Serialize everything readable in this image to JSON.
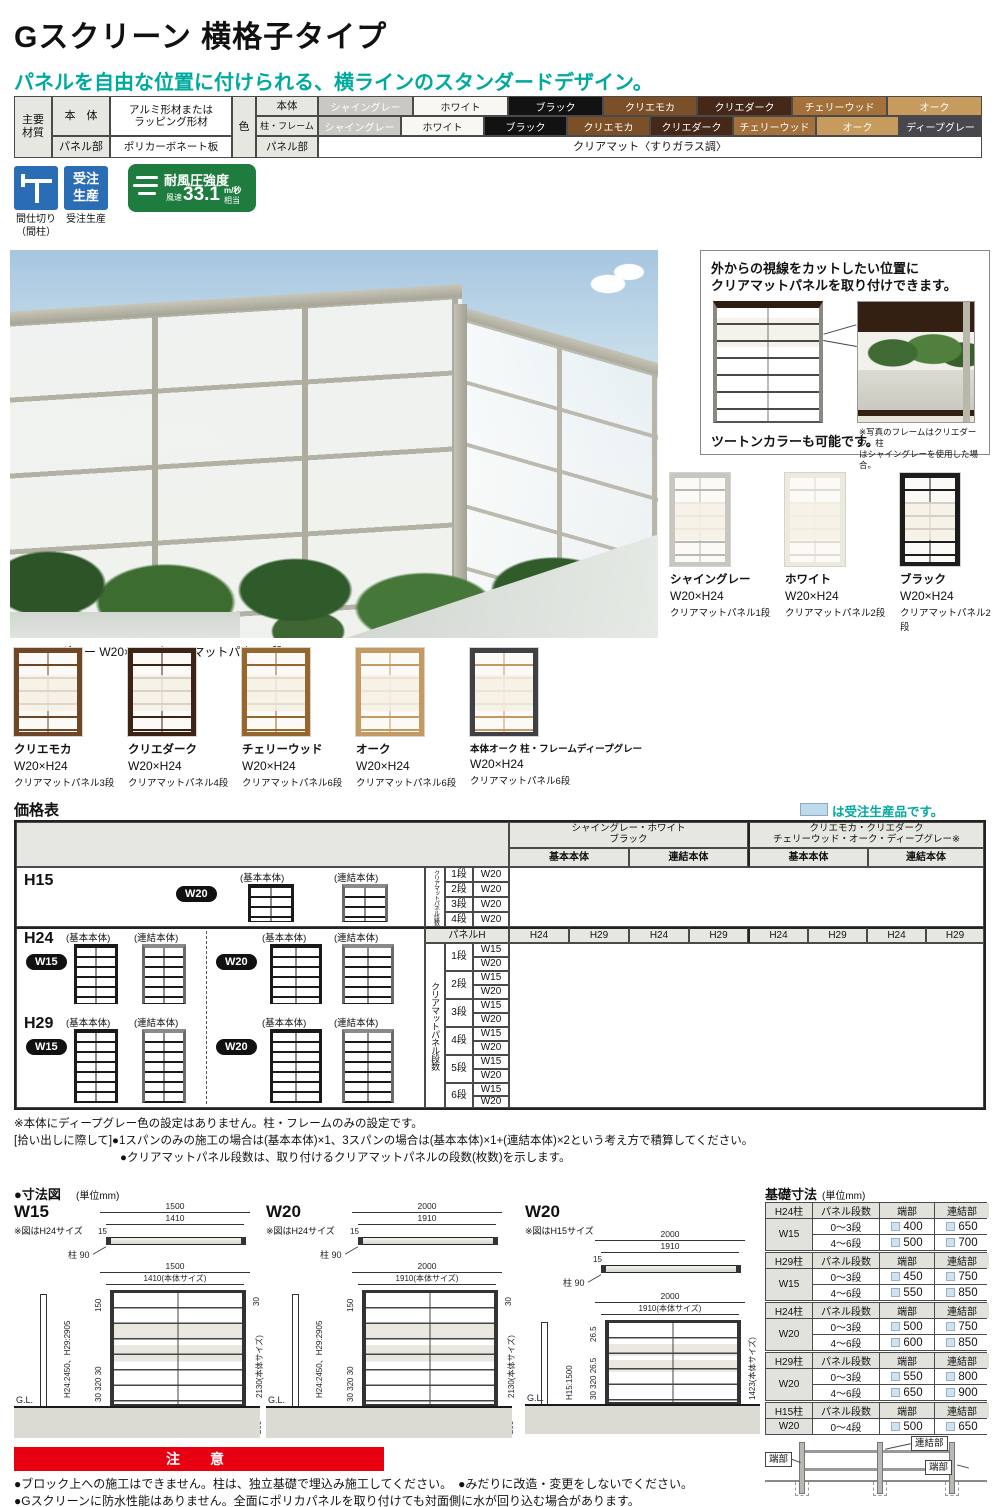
{
  "page": {
    "title": "Gスクリーン 横格子タイプ",
    "subtitle": "パネルを自由な位置に付けられる、横ラインのスタンダードデザイン。"
  },
  "palette": {
    "teal": "#00a99d",
    "red": "#e60012",
    "badge_blue": "#2b6db4",
    "badge_green": "#1e7c3f",
    "legend_blue": "#bedbed",
    "header_gray": "#e7e7e2",
    "shine_gray": "#c9c8c3",
    "white": "#f8f7f2",
    "black": "#121212",
    "crea_mocha": "#7b5029",
    "crea_dark": "#452818",
    "cherry_wood": "#a4713a",
    "oak": "#c79a5d",
    "deep_gray": "#47474d"
  },
  "materials": {
    "main_header": "主要\n材質",
    "body_label": "本　体",
    "body_value": "アルミ形材または\nラッピング形材",
    "panel_part_label": "パネル部",
    "panel_part_value": "ポリカーボネート板",
    "color_header": "色",
    "color_body_label": "本体",
    "color_frame_label": "柱・フレーム",
    "color_panel_label": "パネル部",
    "color_panel_value": "クリアマット〈すりガラス調〉",
    "body_chips": [
      "シャイングレー",
      "ホワイト",
      "ブラック",
      "クリエモカ",
      "クリエダーク",
      "チェリーウッド",
      "オーク"
    ],
    "frame_chips": [
      "シャイングレー",
      "ホワイト",
      "ブラック",
      "クリエモカ",
      "クリエダーク",
      "チェリーウッド",
      "オーク",
      "ディープグレー"
    ]
  },
  "badges": {
    "partition_caption": "間仕切り\n（間柱）",
    "order_icon": "受注\n生産",
    "order_caption": "受注生産",
    "wind_title": "耐風圧強度",
    "wind_prefix": "風速",
    "wind_value": "33.1",
    "wind_unit": "m/秒",
    "wind_suffix": "相当"
  },
  "photo": {
    "caption": "シャイングレー W20×H29 クリアマットパネル5段"
  },
  "callout": {
    "line1": "外からの視線をカットしたい位置に",
    "line2": "クリアマットパネルを取り付けできます。",
    "left_caption": "ツートンカラーも可能です。",
    "right_caption": "※写真のフレームはクリエダーク、柱\nはシャイングレーを使用した場合。"
  },
  "variations": {
    "row1": [
      {
        "name": "シャイングレー",
        "size": "W20×H24",
        "panel": "クリアマットパネル1段"
      },
      {
        "name": "ホワイト",
        "size": "W20×H24",
        "panel": "クリアマットパネル2段"
      },
      {
        "name": "ブラック",
        "size": "W20×H24",
        "panel": "クリアマットパネル2段"
      }
    ],
    "row2": [
      {
        "name": "クリエモカ",
        "size": "W20×H24",
        "panel": "クリアマットパネル3段"
      },
      {
        "name": "クリエダーク",
        "size": "W20×H24",
        "panel": "クリアマットパネル4段"
      },
      {
        "name": "チェリーウッド",
        "size": "W20×H24",
        "panel": "クリアマットパネル6段"
      },
      {
        "name": "オーク",
        "size": "W20×H24",
        "panel": "クリアマットパネル6段"
      },
      {
        "name": "本体オーク 柱・フレームディープグレー",
        "size": "W20×H24",
        "panel": "クリアマットパネル6段"
      }
    ]
  },
  "price": {
    "title": "価格表",
    "legend_text": "は受注生産品です。",
    "group1_line1": "シャイングレー・ホワイト",
    "group1_line2": "ブラック",
    "group2_line1": "クリエモカ・クリエダーク",
    "group2_line2": "チェリーウッド・オーク・ディープグレー※",
    "col_basic": "基本本体",
    "col_link": "連結本体",
    "h15_label": "H15",
    "h24_label": "H24",
    "h29_label": "H29",
    "tag_w15": "W15",
    "tag_w20": "W20",
    "cap_basic": "(基本本体)",
    "cap_link": "(連結本体)",
    "vert_label": "クリアマットパネル段数",
    "panel_h": "パネルH",
    "h_cols": [
      "H24",
      "H29",
      "H24",
      "H29",
      "H24",
      "H29",
      "H24",
      "H29"
    ],
    "h15_dan": [
      "1段",
      "2段",
      "3段",
      "4段"
    ],
    "dan": [
      "1段",
      "2段",
      "3段",
      "4段",
      "5段",
      "6段"
    ],
    "notes": [
      "※本体にディープグレー色の設定はありません。柱・フレームのみの設定です。",
      "[拾い出しに際して]●1スパンのみの施工の場合は(基本本体)×1、3スパンの場合は(基本本体)×1+(連結本体)×2という考え方で積算してください。",
      "●クリアマットパネル段数は、取り付けるクリアマットパネルの段数(枚数)を示します。"
    ]
  },
  "dims": {
    "title": "●寸法図",
    "unit": "(単位mm)",
    "w15": {
      "label": "W15",
      "note": "※図はH24サイズ",
      "plan_outer": "1500",
      "plan_inner": "1410",
      "plan_t": "15",
      "post": "柱 90",
      "front_outer": "1500",
      "front_inner": "1410(本体サイズ)",
      "left_top": "150",
      "height_label": "H24:2450、H29:2905",
      "left_bottom": "30 320 30",
      "right_top": "30",
      "body_label": "2130(本体サイズ)",
      "right_bottom": "200",
      "depth": "500",
      "gl": "G.L."
    },
    "w20": {
      "label": "W20",
      "note": "※図はH24サイズ",
      "plan_outer": "2000",
      "plan_inner": "1910",
      "plan_t": "15",
      "post": "柱 90",
      "front_outer": "2000",
      "front_inner": "1910(本体サイズ)",
      "left_top": "150",
      "height_label": "H24:2450、H29:2905",
      "left_bottom": "30 320 30",
      "right_top": "30",
      "body_label": "2130(本体サイズ)",
      "right_bottom": "200",
      "depth": "500",
      "gl": "G.L."
    },
    "w20h15": {
      "label": "W20",
      "note": "※図はH15サイズ",
      "plan_outer": "2000",
      "plan_inner": "1910",
      "plan_t": "15",
      "post": "柱 90",
      "front_outer": "2000",
      "front_inner": "1910(本体サイズ)",
      "left_top": "26.5",
      "height_label": "H15:1500",
      "left_bottom": "30 320 26.5",
      "body_label": "1423(本体サイズ)",
      "depth": "300",
      "gl": "G.L."
    }
  },
  "foundation": {
    "title": "基礎寸法",
    "unit": "(単位mm)",
    "col_dan": "パネル段数",
    "col_end": "端部",
    "col_link": "連結部",
    "tables": [
      {
        "post": "H24柱",
        "w": "W15",
        "rows": [
          {
            "dan": "0～3段",
            "end": "400",
            "link": "650"
          },
          {
            "dan": "4～6段",
            "end": "500",
            "link": "700"
          }
        ]
      },
      {
        "post": "H29柱",
        "w": "W15",
        "rows": [
          {
            "dan": "0～3段",
            "end": "450",
            "link": "750"
          },
          {
            "dan": "4～6段",
            "end": "550",
            "link": "850"
          }
        ]
      },
      {
        "post": "H24柱",
        "w": "W20",
        "rows": [
          {
            "dan": "0～3段",
            "end": "500",
            "link": "750"
          },
          {
            "dan": "4～6段",
            "end": "600",
            "link": "850"
          }
        ]
      },
      {
        "post": "H29柱",
        "w": "W20",
        "rows": [
          {
            "dan": "0～3段",
            "end": "550",
            "link": "800"
          },
          {
            "dan": "4～6段",
            "end": "650",
            "link": "900"
          }
        ]
      },
      {
        "post": "H15柱",
        "w": "W20",
        "rows": [
          {
            "dan": "0～4段",
            "end": "500",
            "link": "650"
          }
        ]
      }
    ],
    "diag_end_left": "端部",
    "diag_link": "連結部",
    "diag_end_right": "端部"
  },
  "caution": {
    "banner": "注　意",
    "notes": [
      "●ブロック上への施工はできません。柱は、独立基礎で埋込み施工してください。　●みだりに改造・変更をしないでください。",
      "●Gスクリーンに防水性能はありません。全面にポリカパネルを取り付けても対面側に水が回り込む場合があります。"
    ]
  }
}
